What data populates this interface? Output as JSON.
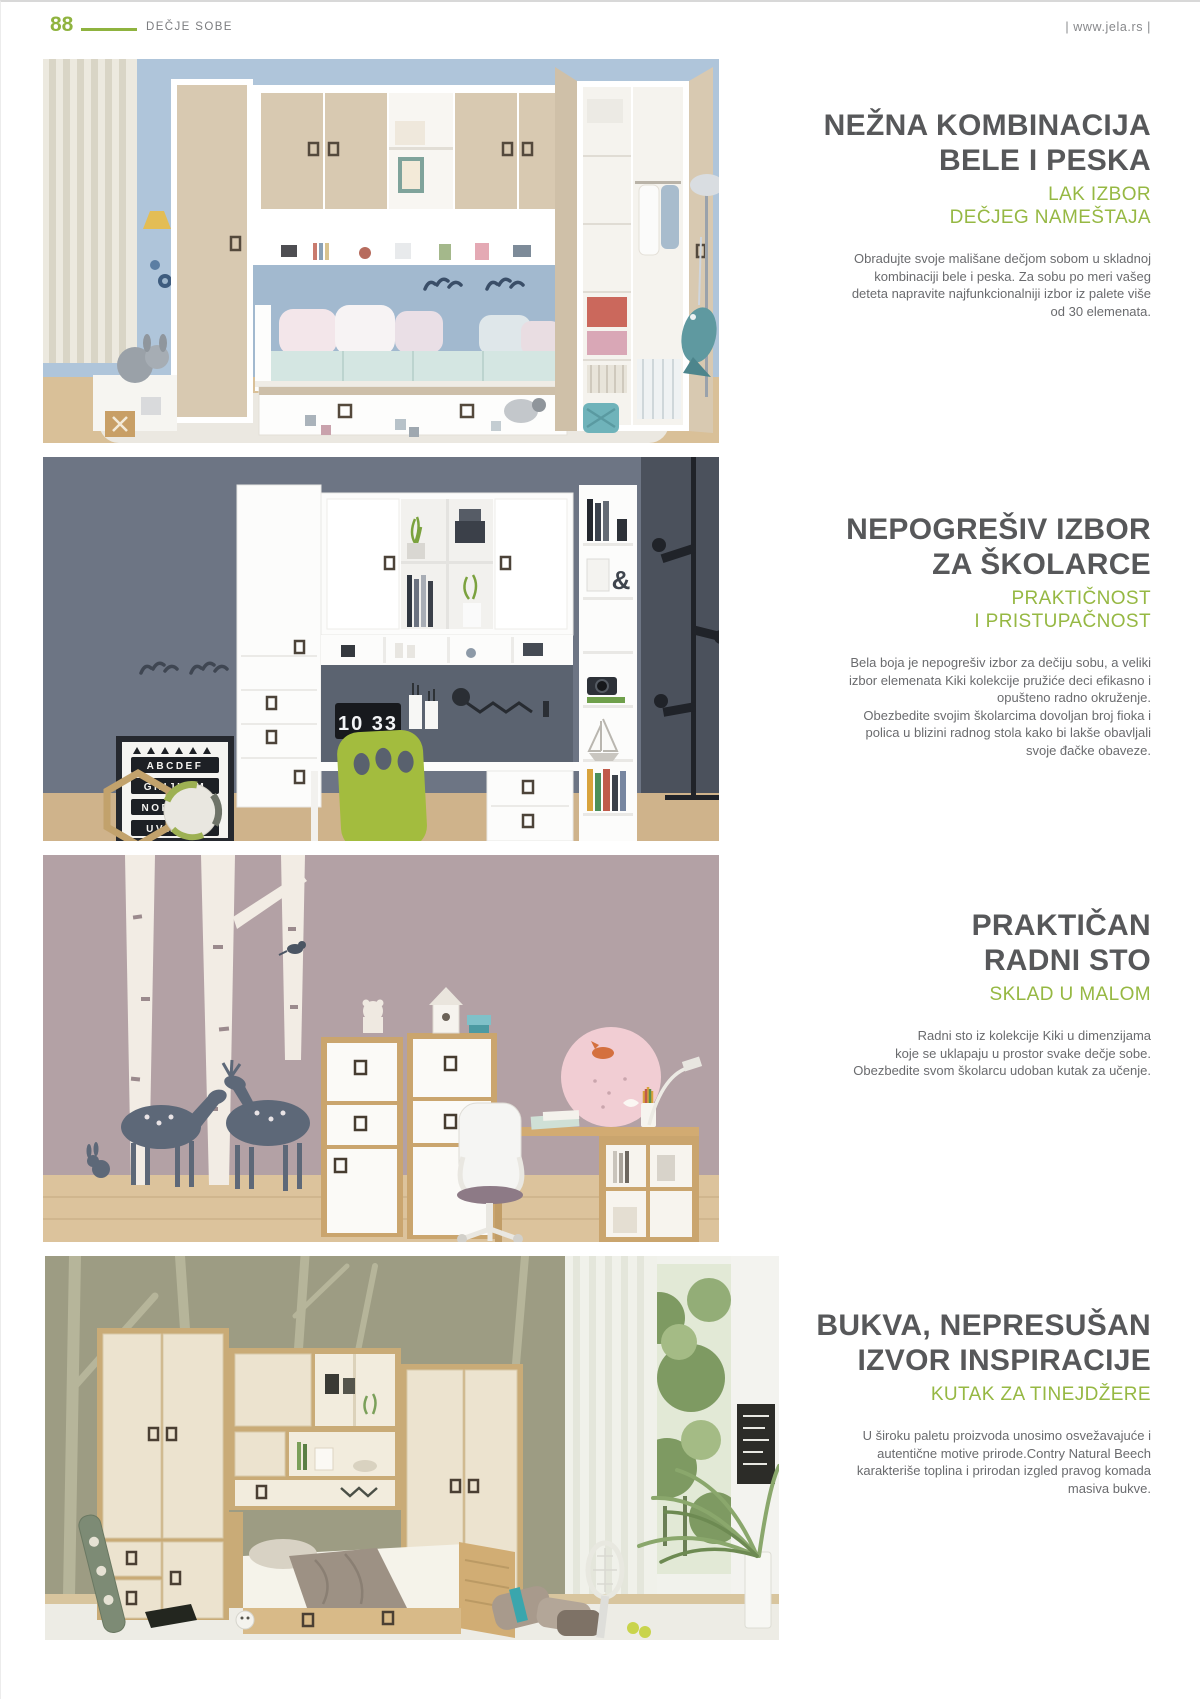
{
  "page_header": {
    "page_number": "88",
    "section_label": "DEČJE SOBE",
    "website": "| www.jela.rs |"
  },
  "colors": {
    "accent_green": "#96b843",
    "title_gray": "#57585a",
    "body_gray": "#6a6b6e"
  },
  "sections": [
    {
      "title_line1": "NEŽNA KOMBINACIJA",
      "title_line2": "BELE I PESKA",
      "subtitle_line1": "LAK IZBOR",
      "subtitle_line2": "DEČJEG NAMEŠTAJA",
      "body": "Obradujte  svoje mališane dečjom sobom u skladnoj\nkombinaciji bele i peska. Za sobu po meri vašeg\ndeteta napravite najfunkcionalniji izbor iz palete više\nod 30 elemenata.",
      "photo_alt": "kids-room-in-white-and-sand"
    },
    {
      "title_line1": "NEPOGREŠIV IZBOR",
      "title_line2": "ZA ŠKOLARCE",
      "subtitle_line1": "PRAKTIČNOST",
      "subtitle_line2": "I PRISTUPAČNOST",
      "body": "Bela boja je nepogrešiv izbor za dečiju sobu, a veliki\nizbor elemenata Kiki kolekcije pružiće deci efikasno i\nopušteno radno okruženje.\nObezbedite svojim školarcima dovoljan broj fioka i\npolica u blizini radnog stola kako bi lakše obavljali\nsvoje đačke obaveze.",
      "photo_alt": "white-study-wall-unit-gray-room",
      "clock_time": "10 33",
      "poster_rows": [
        "ABCDEF",
        "GHIJKLM",
        "NOPQRST",
        "UVWXYZ"
      ]
    },
    {
      "title_line1": "PRAKTIČAN",
      "title_line2": "RADNI STO",
      "subtitle_line1": "SKLAD U MALOM",
      "body": "Radni sto iz kolekcije Kiki u dimenzijama\nkoje se uklapaju u  prostor svake dečje sobe.\nObezbedite svom školarcu udoban kutak za učenje.",
      "photo_alt": "kiki-desk-mauve-room-with-deer-decals"
    },
    {
      "title_line1": "BUKVA, NEPRESUŠAN",
      "title_line2": "IZVOR INSPIRACIJE",
      "subtitle_line1": "KUTAK ZA TINEJDŽERE",
      "body": "U široku paletu proizvoda unosimo osvežavajuće i\nautentične motive prirode.Contry Natural Beech\nkarakteriše toplina i prirodan izgled pravog komada\nmasiva bukve.",
      "photo_alt": "beech-teen-room-green-wall"
    }
  ]
}
